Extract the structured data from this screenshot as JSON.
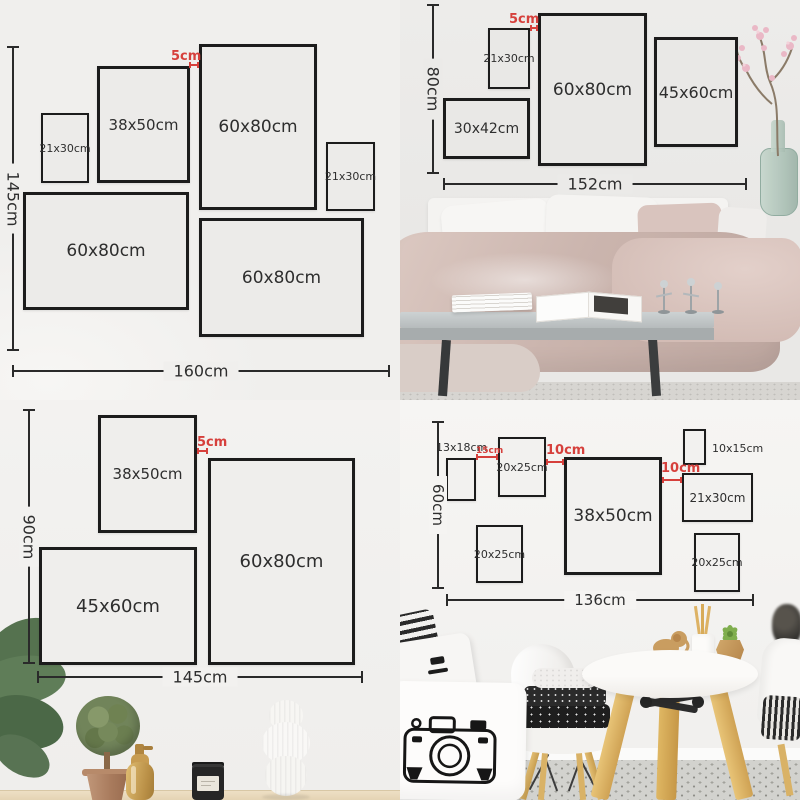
{
  "colors": {
    "accent_red": "#d6403c",
    "frame_border": "#1c1c1c",
    "wall_gray": "#f0efed",
    "wood": "#d9b266",
    "duvet_mauve": "#c9b3ac"
  },
  "quadrants": {
    "top_left": {
      "vertical_dim": "145cm",
      "horizontal_dim": "160cm",
      "gap_label": "5cm",
      "frames": [
        {
          "label": "21x30cm"
        },
        {
          "label": "38x50cm"
        },
        {
          "label": "60x80cm"
        },
        {
          "label": "21x30cm"
        },
        {
          "label": "60x80cm"
        },
        {
          "label": "60x80cm"
        }
      ]
    },
    "top_right": {
      "vertical_dim": "80cm",
      "horizontal_dim": "152cm",
      "gap_label": "5cm",
      "frames": [
        {
          "label": "21x30cm"
        },
        {
          "label": "60x80cm"
        },
        {
          "label": "45x60cm"
        },
        {
          "label": "30x42cm"
        }
      ]
    },
    "bottom_left": {
      "vertical_dim": "90cm",
      "horizontal_dim": "145cm",
      "gap_label": "5cm",
      "frames": [
        {
          "label": "38x50cm"
        },
        {
          "label": "60x80cm"
        },
        {
          "label": "45x60cm"
        }
      ]
    },
    "bottom_right": {
      "vertical_dim": "60cm",
      "horizontal_dim": "136cm",
      "gap_labels": [
        "15cm",
        "10cm",
        "10cm"
      ],
      "frames": [
        {
          "label": "13x18cm"
        },
        {
          "label": "20x25cm"
        },
        {
          "label": "38x50cm"
        },
        {
          "label": "10x15cm"
        },
        {
          "label": "21x30cm"
        },
        {
          "label": "20x25cm"
        },
        {
          "label": "20x25cm"
        }
      ]
    }
  }
}
